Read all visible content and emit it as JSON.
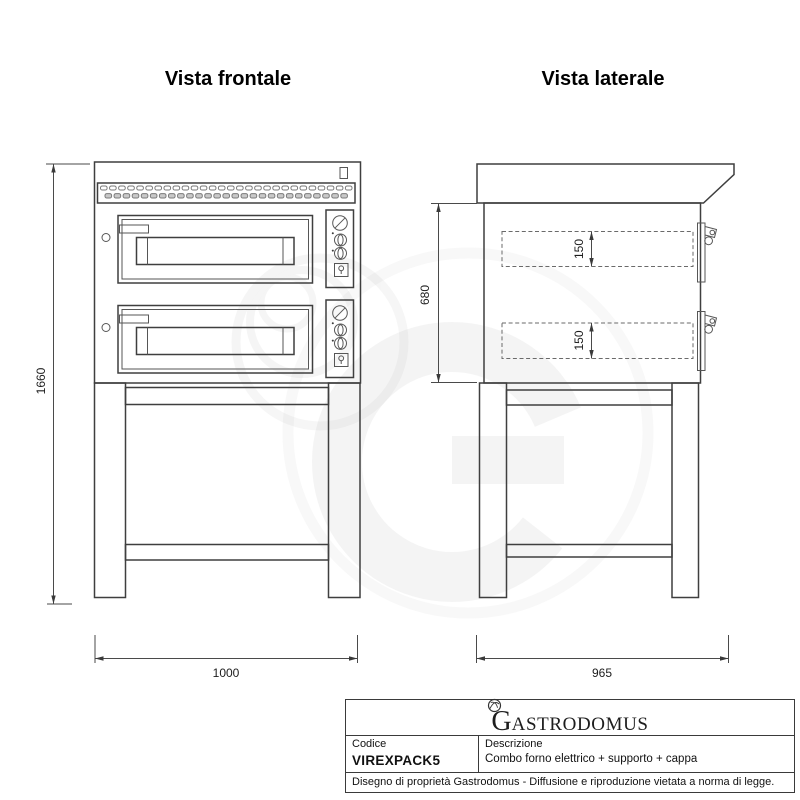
{
  "sheet": {
    "front_view": {
      "title": "Vista frontale",
      "dimensions": {
        "overall_height_mm": "1660",
        "overall_width_mm": "1000"
      }
    },
    "side_view": {
      "title": "Vista laterale",
      "dimensions": {
        "body_height_mm": "680",
        "overall_depth_mm": "965",
        "upper_chamber_height_mm": "150",
        "lower_chamber_height_mm": "150"
      }
    }
  },
  "title_block": {
    "brand": {
      "initial": "G",
      "rest": "ASTRODOMUS"
    },
    "code": {
      "label": "Codice",
      "value": "VIREXPACK5"
    },
    "description": {
      "label": "Descrizione",
      "value": "Combo forno elettrico + supporto + cappa"
    },
    "notice": "Disegno di proprietà Gastrodomus - Diffusione e riproduzione vietata a norma di legge."
  },
  "colors": {
    "line": "#3f3f3f",
    "dim_line": "#4a4a4a",
    "text": "#1a1a1a"
  }
}
